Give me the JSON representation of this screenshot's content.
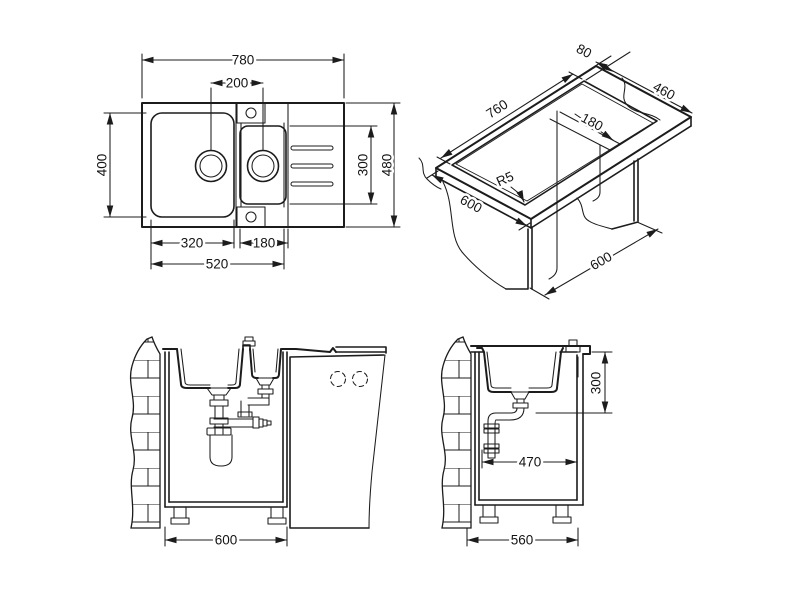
{
  "colors": {
    "line": "#1c1c1c",
    "background": "#ffffff"
  },
  "views": {
    "plan": {
      "overall_width": "780",
      "drain_spacing": "200",
      "bowl_length": "400",
      "right_section_width": "300",
      "overall_depth": "480",
      "main_bowl_width": "320",
      "half_bowl_width": "180",
      "bowls_span": "520"
    },
    "isometric": {
      "cutout_length": "760",
      "rear_edge_offset": "80",
      "cutout_width": "460",
      "strip_width": "180",
      "corner_radius": "R5",
      "worktop_depth": "600",
      "cabinet_width": "600"
    },
    "front_section": {
      "cabinet_width": "600"
    },
    "side_section": {
      "drain_depth": "300",
      "trap_offset": "470",
      "cabinet_depth": "560"
    }
  }
}
